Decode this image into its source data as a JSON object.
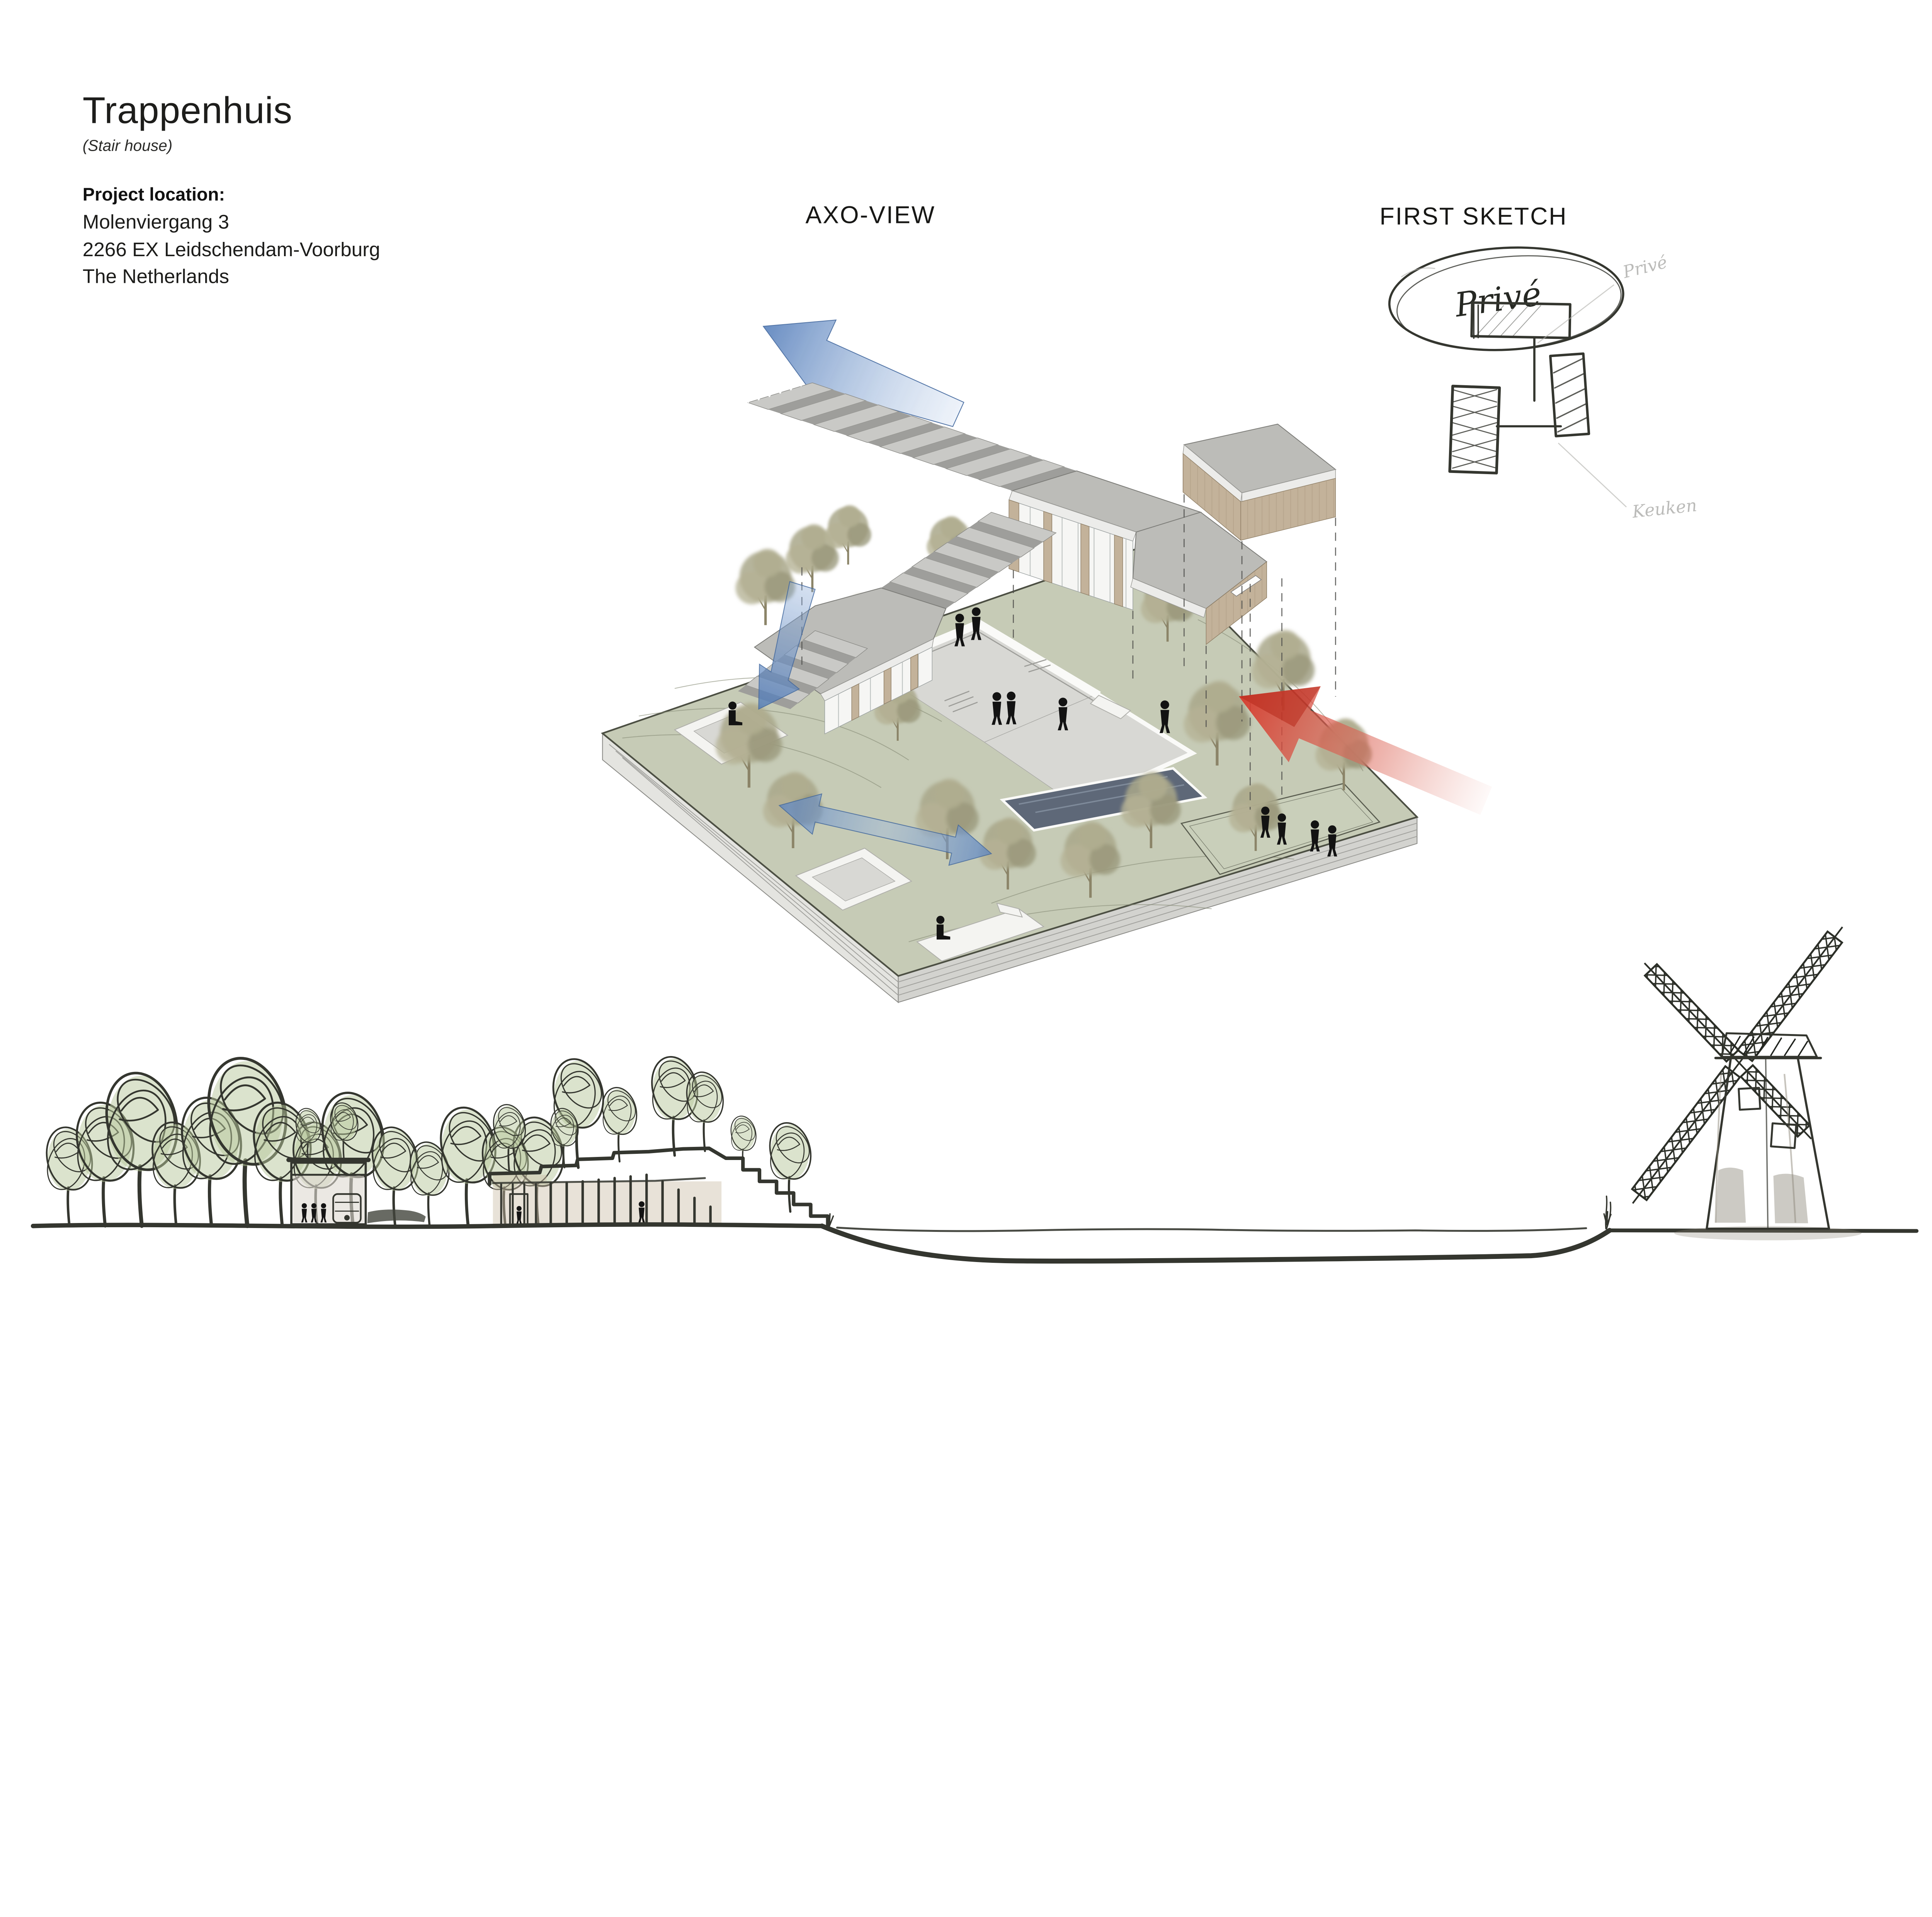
{
  "board": {
    "background": "#ffffff"
  },
  "palette": {
    "accent_blue": "#5b83c4",
    "accent_blue_light": "#b9cde9",
    "accent_red": "#d63a2c",
    "site_green": "#c6cbb6",
    "roof_grey": "#bcbcb8",
    "wood": "#c3b29a",
    "ink": "#34362f",
    "sketch_green": "#b8c79c",
    "windmill_grey": "#b4afa6"
  },
  "title_block": {
    "title": "Trappenhuis",
    "subtitle": "(Stair house)",
    "location_label": "Project location:",
    "address_line1": "Molenviergang 3",
    "address_line2": "2266 EX Leidschendam-Voorburg",
    "address_line3": "The Netherlands"
  },
  "axo_view": {
    "label": "AXO-VIEW",
    "icons": {
      "exit_arrow_top": "blue-arrow-up-left",
      "exit_arrow_site": "blue-arrow-down-left",
      "cross_site_arrow": "blue-double-arrow",
      "entry_arrow": "red-arrow"
    }
  },
  "first_sketch": {
    "label": "FIRST SKETCH",
    "bubble_text": "Privé",
    "pencil_note_top": "Privé",
    "pencil_note_bottom": "Keuken"
  },
  "section_sketch": {
    "elements": [
      "tree-row",
      "pavilion",
      "green-roof-building",
      "canal",
      "windmill"
    ]
  }
}
